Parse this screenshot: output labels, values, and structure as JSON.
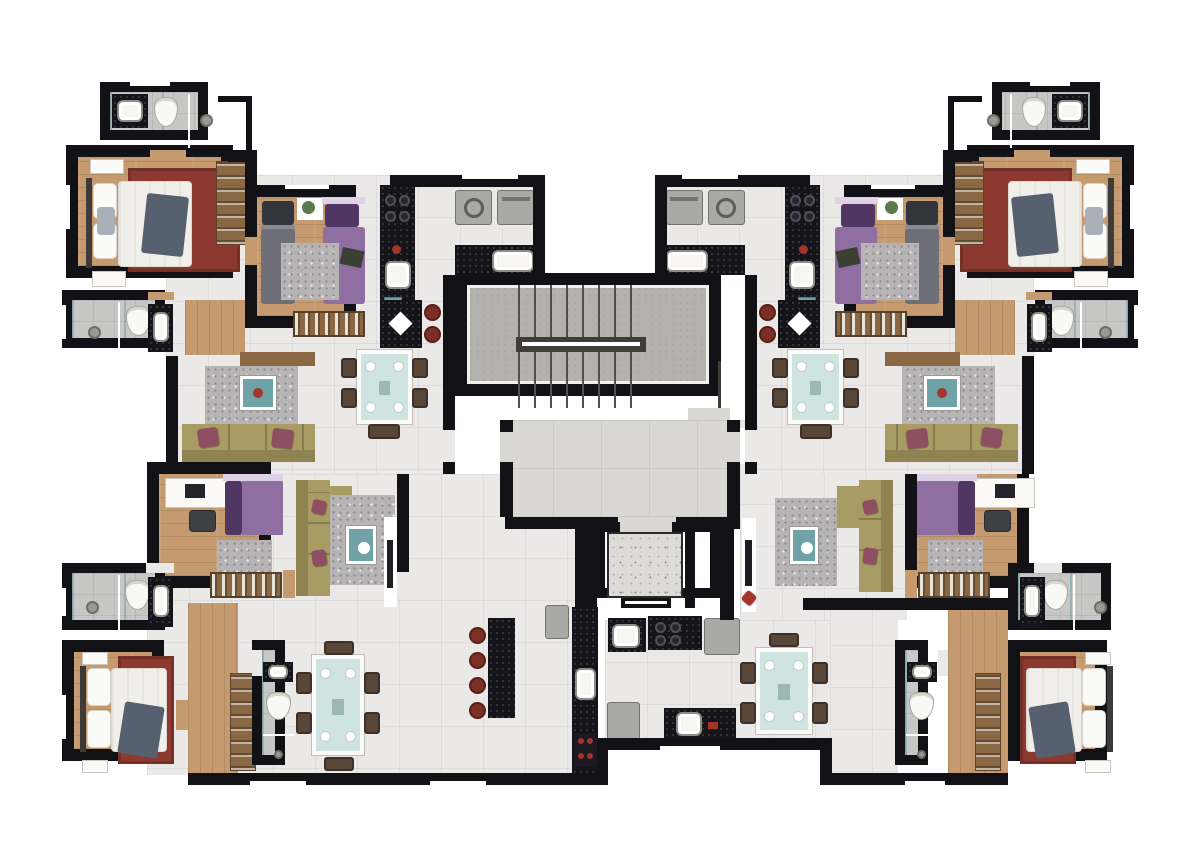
{
  "meta": {
    "kind": "architectural floor plan rendering",
    "view": "top-down",
    "text_visible": ""
  },
  "palette": {
    "wall": "#121216",
    "white": "#ffffff",
    "floor": "#eae9e7",
    "floorhall": "#d8d7d4",
    "floorbath": "#c7c7c5",
    "wood": "#c49a6e",
    "wood2": "#8a6844",
    "concrete": "#b4b3ab",
    "granite": "#dcdbd6",
    "counter": "#14141a",
    "rugred": "#8c3a30",
    "ruggray": "#b7b4b5",
    "sofa": "#a89b63",
    "sofad": "#8f8352",
    "maroon": "#8f4f62",
    "throw": "#57606e",
    "purple": "#8f6fa1",
    "purpledark": "#503663",
    "graybed": "#6f6f79",
    "appl": "#a9a9a7",
    "teal": "#6fa3a8",
    "tabletop": "#cfe3e0",
    "chair": "#584739",
    "stool": "#7c2f24",
    "accentred": "#a23528",
    "plant": "#5d7a4d"
  },
  "building": {
    "core": {
      "rooms": [
        "stairwell",
        "hall",
        "elevator-car",
        "elevator-shaft"
      ]
    },
    "units": [
      {
        "id": "upper-left",
        "rooms": [
          "bathroom-ensuite",
          "master-bedroom",
          "second-bedroom",
          "kitchen",
          "laundry",
          "living-room",
          "dining-area",
          "bathroom"
        ]
      },
      {
        "id": "upper-right",
        "mirror_of": "upper-left"
      },
      {
        "id": "lower-left",
        "rooms": [
          "bedroom-office",
          "living-room",
          "kitchen",
          "dining-area",
          "bathroom",
          "master-bedroom",
          "powder-room",
          "corridor"
        ]
      },
      {
        "id": "lower-right",
        "rooms": [
          "bedroom-office",
          "living-room",
          "kitchen",
          "dining-area",
          "bathroom",
          "master-bedroom",
          "powder-room",
          "corridor"
        ]
      }
    ],
    "furniture_legend": [
      "double-bed",
      "single-bed",
      "wardrobe",
      "shoe-rack",
      "sofa",
      "chaise",
      "rug",
      "coffee-table",
      "tv-console",
      "dining-table",
      "chair",
      "bar-stool",
      "kitchen-counter",
      "cooktop",
      "kitchen-sink",
      "washer",
      "dryer",
      "fridge",
      "toilet",
      "bathroom-sink",
      "shower-head",
      "desk",
      "nightstand"
    ]
  }
}
